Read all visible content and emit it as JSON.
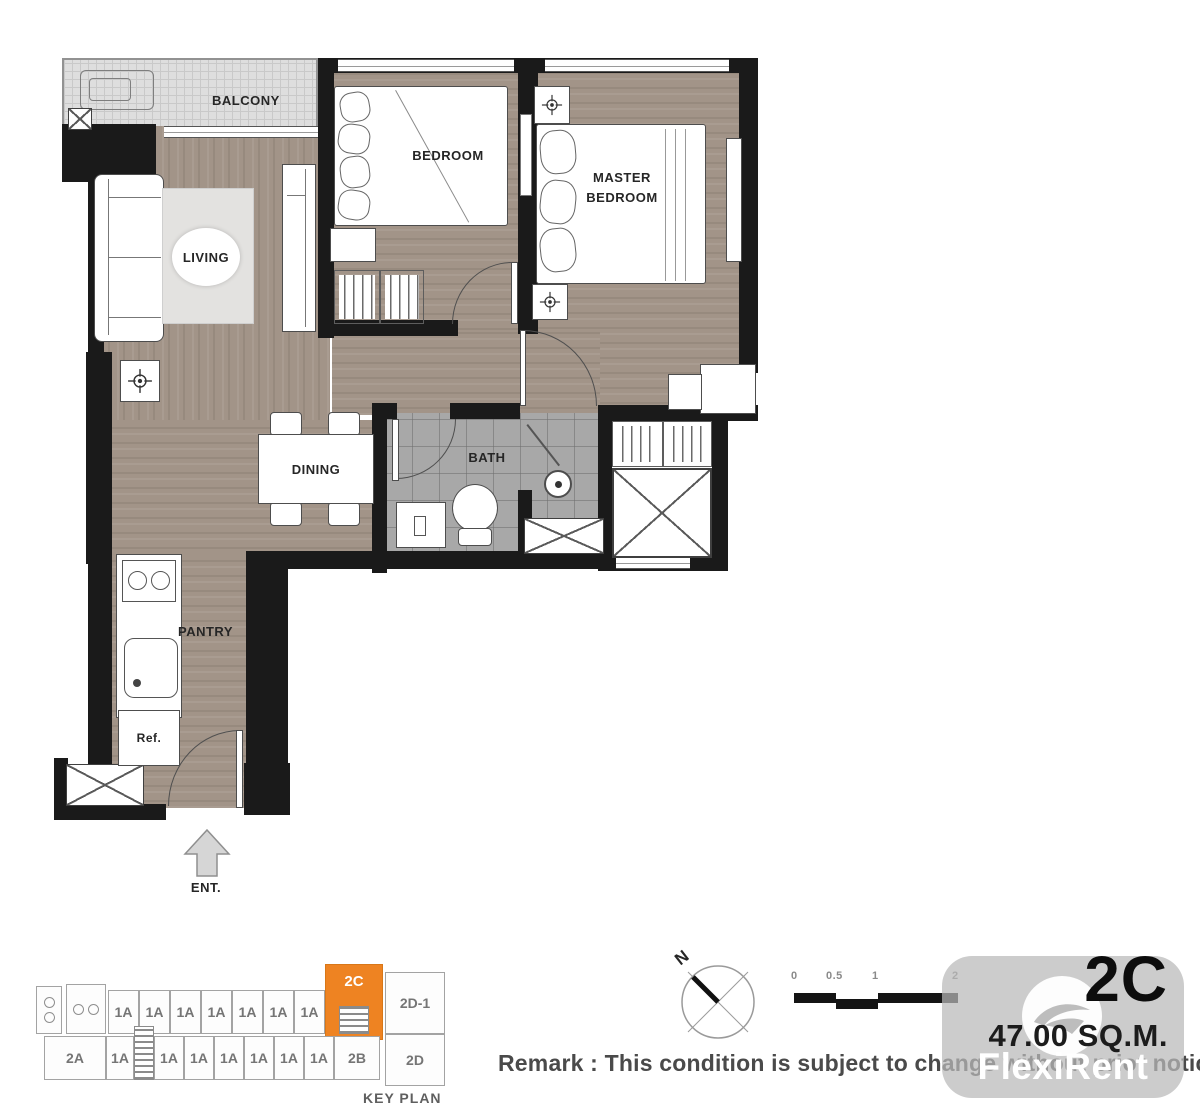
{
  "plan": {
    "rooms": {
      "balcony": "BALCONY",
      "living": "LIVING",
      "bedroom": "BEDROOM",
      "master_bedroom": "MASTER BEDROOM",
      "dining": "DINING",
      "bath": "BATH",
      "pantry": "PANTRY",
      "refrigerator": "Ref.",
      "entrance": "ENT."
    },
    "compass_label": "N",
    "scale_ticks": [
      "0",
      "0.5",
      "1",
      "2"
    ]
  },
  "key_plan": {
    "label": "KEY PLAN",
    "top_row": [
      "1A",
      "1A",
      "1A",
      "1A",
      "1A",
      "1A",
      "1A"
    ],
    "unit_2c": "2C",
    "unit_2d1": "2D-1",
    "unit_2a": "2A",
    "bottom_row": [
      "1A",
      "1A",
      "1A",
      "1A",
      "1A",
      "1A",
      "1A"
    ],
    "unit_2b": "2B",
    "unit_2d": "2D",
    "highlight_color": "#EE8322"
  },
  "unit_info": {
    "unit": "2C",
    "area": "47.00 SQ.M."
  },
  "remark": "Remark : This condition is subject to change without prior notice",
  "watermark": {
    "brand": "FlexiRent"
  },
  "colors": {
    "wall": "#1a1a1a",
    "wood": "#a29488",
    "bath_tile": "#a8a8a8",
    "balcony_floor": "#dedede",
    "highlight": "#EE8322"
  }
}
